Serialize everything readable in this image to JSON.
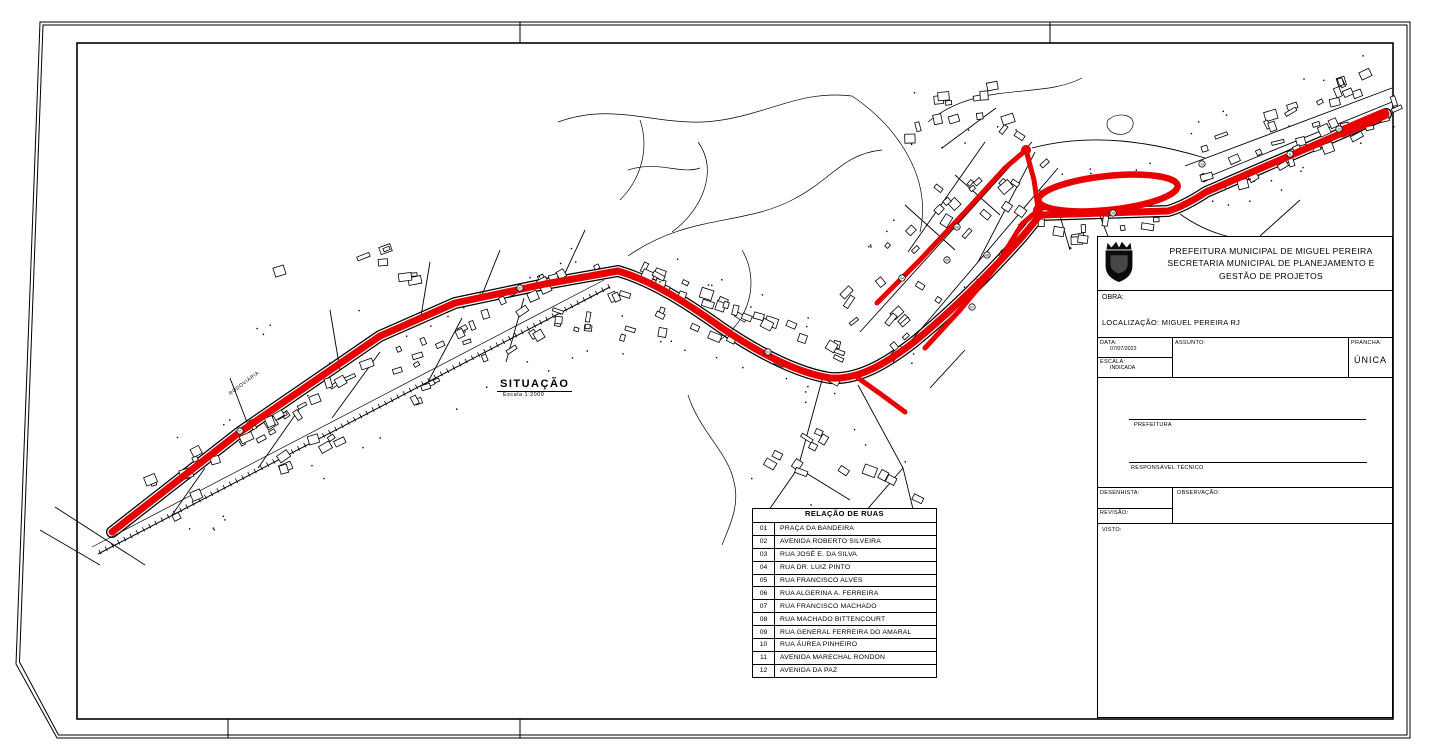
{
  "sheet": {
    "background": "#ffffff",
    "line_color": "#000000"
  },
  "map": {
    "situacao_label": "SITUAÇÃO",
    "situacao_scale": "Escala 1:2000",
    "rodoviaria_label": "RODOVIÁRIA",
    "route_color": "#e80000",
    "route_markers": [
      {
        "n": "01",
        "x": 240,
        "y": 431
      },
      {
        "n": "02",
        "x": 520,
        "y": 288
      },
      {
        "n": "03",
        "x": 768,
        "y": 352
      },
      {
        "n": "04",
        "x": 902,
        "y": 278
      },
      {
        "n": "05",
        "x": 947,
        "y": 260
      },
      {
        "n": "06",
        "x": 957,
        "y": 227
      },
      {
        "n": "07",
        "x": 972,
        "y": 307
      },
      {
        "n": "08",
        "x": 987,
        "y": 255
      },
      {
        "n": "09",
        "x": 1113,
        "y": 213
      },
      {
        "n": "10",
        "x": 1202,
        "y": 164
      },
      {
        "n": "11",
        "x": 1290,
        "y": 154
      },
      {
        "n": "12",
        "x": 1339,
        "y": 129
      }
    ]
  },
  "streets_table": {
    "title": "RELAÇÃO DE RUAS",
    "rows": [
      {
        "num": "01",
        "name": "PRAÇA DA BANDEIRA"
      },
      {
        "num": "02",
        "name": "AVENIDA ROBERTO SILVEIRA"
      },
      {
        "num": "03",
        "name": "RUA JOSÉ E. DA SILVA"
      },
      {
        "num": "04",
        "name": "RUA DR. LUIZ PINTO"
      },
      {
        "num": "05",
        "name": "RUA FRANCISCO ALVES"
      },
      {
        "num": "06",
        "name": "RUA ALGERINA A. FERREIRA"
      },
      {
        "num": "07",
        "name": "RUA FRANCISCO MACHADO"
      },
      {
        "num": "08",
        "name": "RUA MACHADO BITTENCOURT"
      },
      {
        "num": "09",
        "name": "RUA GENERAL FERREIRA DO AMARAL"
      },
      {
        "num": "10",
        "name": "RUA ÁUREA PINHEIRO"
      },
      {
        "num": "11",
        "name": "AVENIDA MARECHAL RONDON"
      },
      {
        "num": "12",
        "name": "AVENIDA DA PAZ"
      }
    ]
  },
  "title_block": {
    "org_line1": "PREFEITURA MUNICIPAL DE MIGUEL PEREIRA",
    "org_line2": "SECRETARIA MUNICIPAL DE PLANEJAMENTO E",
    "org_line3": "GESTÃO DE PROJETOS",
    "obra_label": "OBRA:",
    "localizacao": "LOCALIZAÇÃO: MIGUEL PEREIRA RJ",
    "data_label": "DATA:",
    "data_value": "07/07/2022",
    "escala_label": "ESCALA:",
    "escala_value": "INDICADA",
    "assunto_label": "ASSUNTO:",
    "prancha_label": "PRANCHA:",
    "prancha_value": "ÚNICA",
    "prefeitura_label": "PREFEITURA",
    "resp_tecnico_label": "RESPONSÁVEL TÉCNICO",
    "desenhista_label": "DESENHISTA:",
    "observacao_label": "OBSERVAÇÃO:",
    "revisao_label": "REVISÃO:",
    "visto_label": "VISTO:"
  }
}
